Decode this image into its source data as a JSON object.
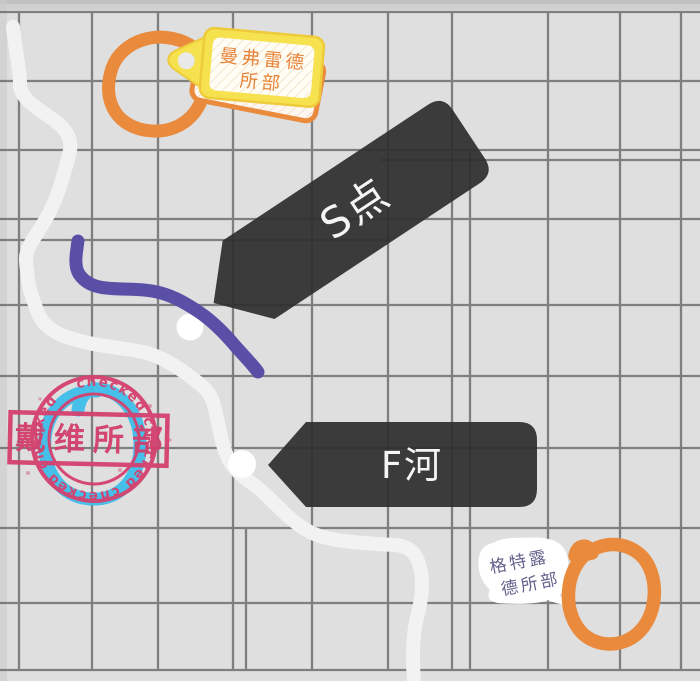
{
  "map": {
    "labels": {
      "tag_line1": "曼弗雷德",
      "tag_line2": "所部",
      "point_s": "S点",
      "river_f": "F河",
      "stamp_name": "戴维所部",
      "stamp_ring": "checked   checked   checked   checked  ",
      "bubble_line1": "格特露",
      "bubble_line2": "德所部"
    },
    "colors": {
      "background": "#dfdfdf",
      "grid_line": "#6a6a6a",
      "banner_dark": "#2e2e2e",
      "banner_text": "#f5f5f5",
      "road_white": "#f2f2f2",
      "route_purple": "#5a4fa6",
      "mark_blue": "#3ebee9",
      "mark_orange": "#e98a3d",
      "tag_yellow": "#f6e14e",
      "tag_text_orange": "#e8853c",
      "stamp_pink": "#d5406e",
      "bubble_text": "#62628c"
    }
  }
}
